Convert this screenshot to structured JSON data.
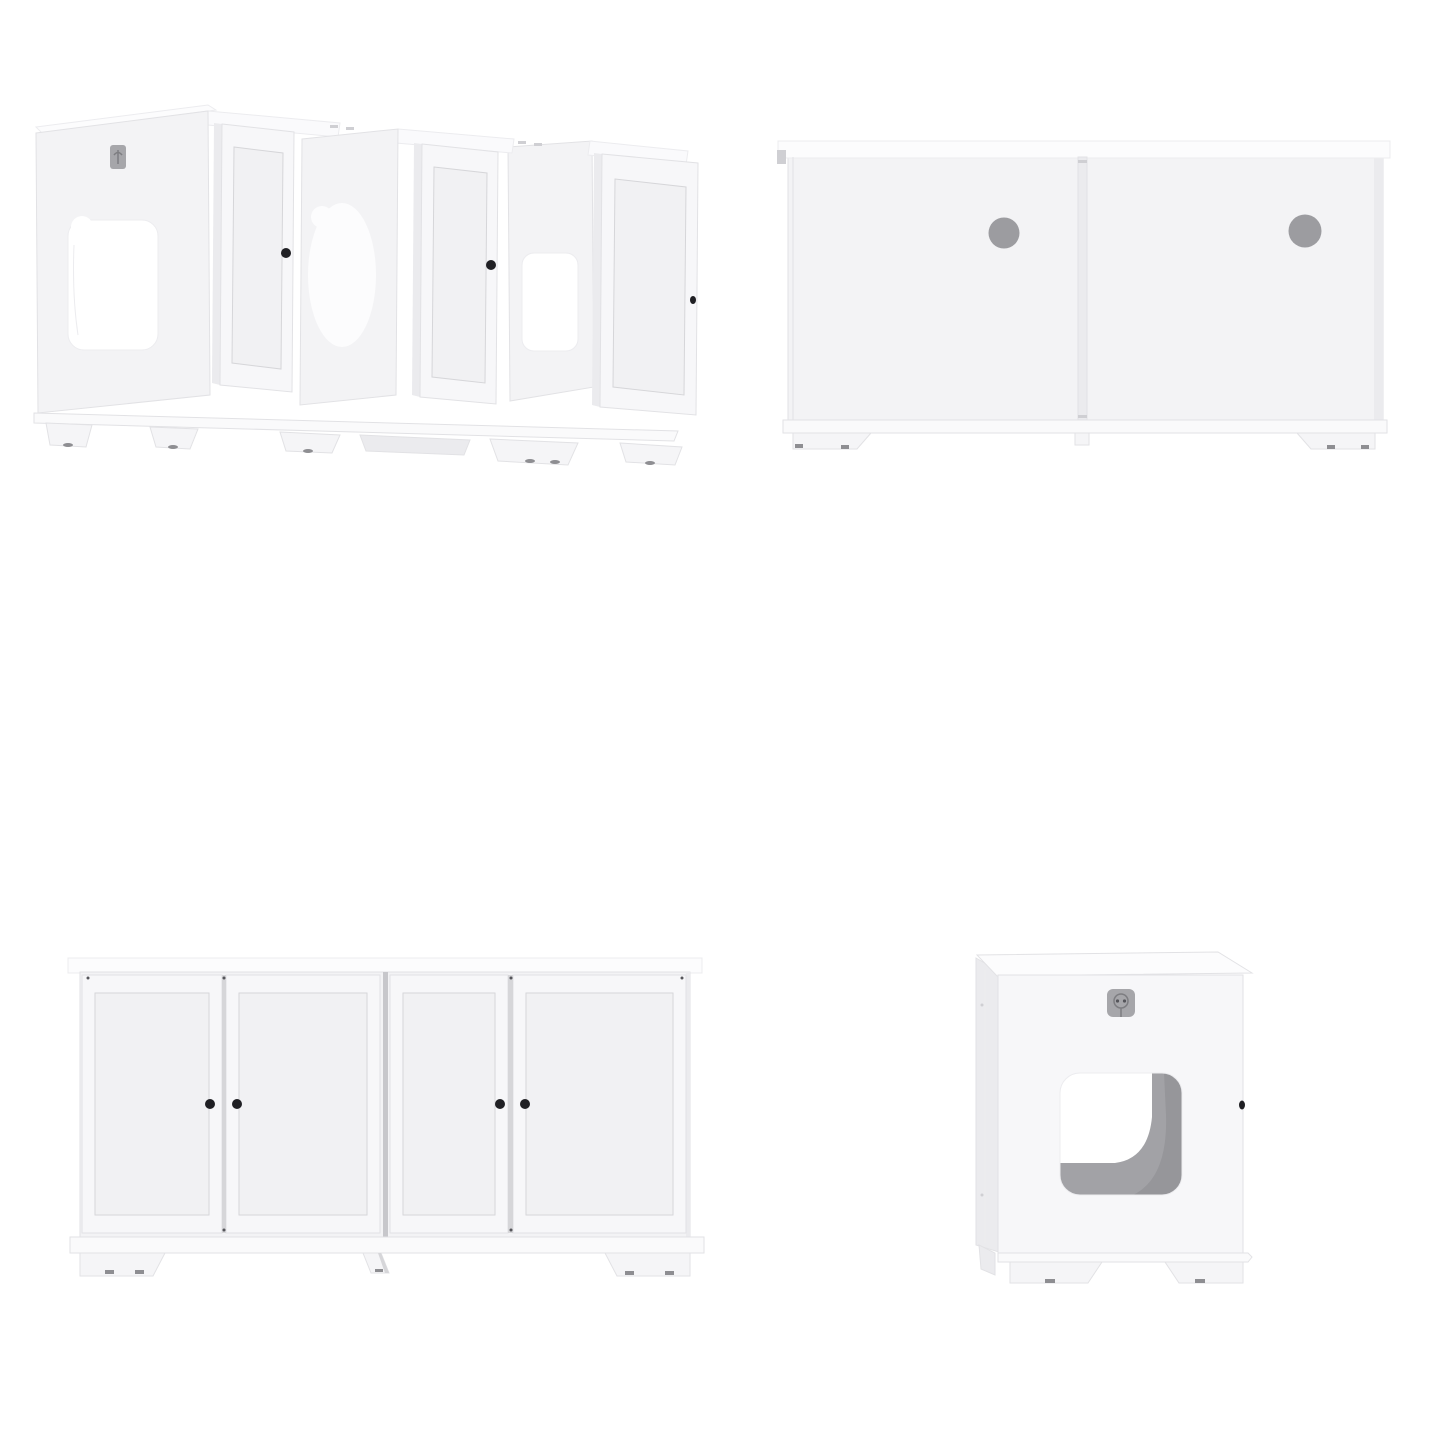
{
  "canvas": {
    "width": 1445,
    "height": 1445,
    "background": "#ffffff"
  },
  "product": {
    "name": "white-cat-litter-box-enclosure-2-piece",
    "views": {
      "perspective": {
        "label": "perspective view with three doors open and cutout openings",
        "open_doors": 3,
        "knobs": 3,
        "pass_through_oval": 1,
        "side_cutout": 1,
        "logo_badge": 1
      },
      "back": {
        "label": "back view with two round cable holes",
        "panels": 2,
        "cable_holes": 2
      },
      "front": {
        "label": "front view with four closed shaker doors and black knobs",
        "doors": 4,
        "knobs": 4,
        "feet": 3
      },
      "side": {
        "label": "side view with square entry hole and logo badge",
        "entry_holes": 1,
        "logo_badge": 1,
        "edge_knob": 1,
        "feet": 2
      }
    },
    "palette": {
      "white": "#ffffff",
      "panel": "#f3f3f5",
      "bright": "#fcfcfd",
      "shadow": "#ebebee",
      "deck": "#fafafc",
      "doorface": "#f7f7f9",
      "inpanel": "#f1f1f3",
      "base": "#fafafb",
      "foot": "#f5f5f7",
      "edge": "#e2e2e5",
      "soft": "#ececef",
      "inedge": "#d6d6d9",
      "seam": "#c7c7cb",
      "hole": "#9c9ca0",
      "knob": "#202024",
      "interior": "#a2a2a6",
      "interior_dark": "#96969a",
      "pad": "#8e8e92",
      "badge": "#a6a6aa",
      "badge_glyph": "#7d7d81",
      "mark": "#cfcfd3",
      "dot": "#55555a"
    }
  }
}
